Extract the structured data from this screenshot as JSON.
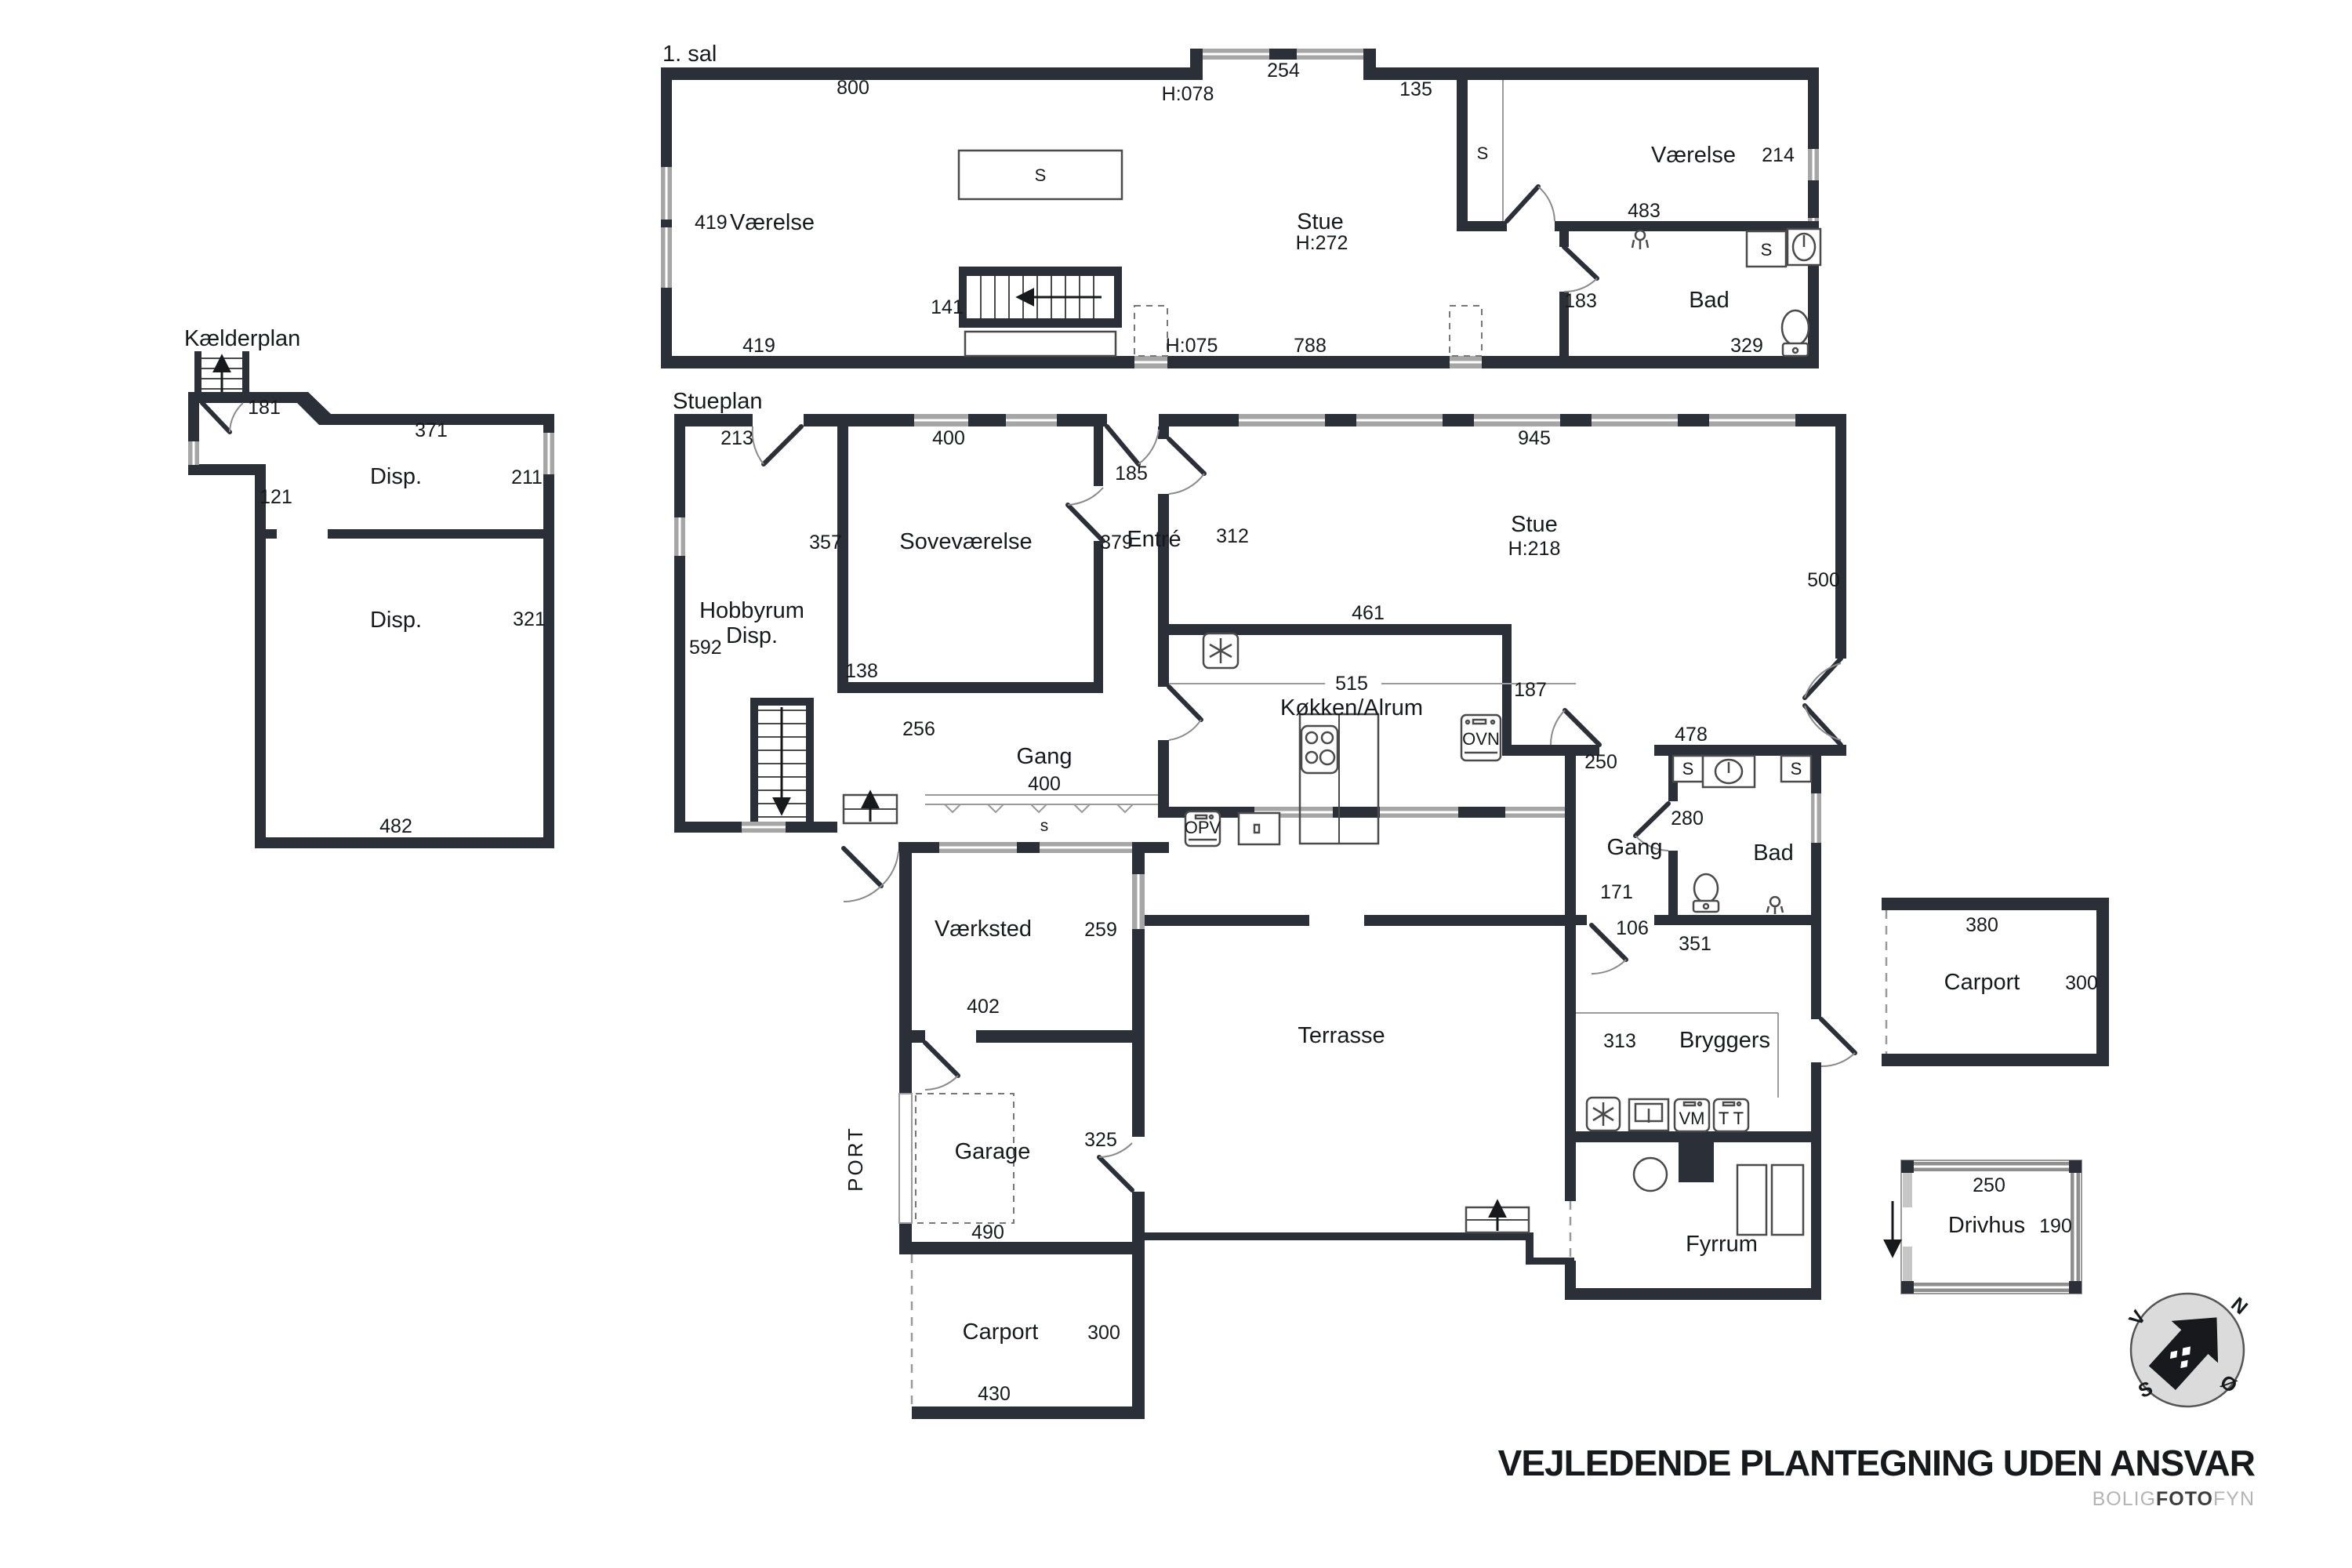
{
  "first_floor": {
    "title": "1. sal",
    "room_left": "Værelse",
    "room_stue": "Stue",
    "stue_h": "H:272",
    "room_right": "Værelse",
    "room_bad": "Bad",
    "closet_mid": "S",
    "closet_right": "S",
    "closet_bad": "S",
    "d_800": "800",
    "d_254": "254",
    "d_h078": "H:078",
    "d_135": "135",
    "d_419_left": "419",
    "d_214": "214",
    "d_483": "483",
    "d_141": "141",
    "d_183": "183",
    "d_329": "329",
    "d_788": "788",
    "d_419_bottom": "419",
    "d_h075": "H:075"
  },
  "basement": {
    "title": "Kælderplan",
    "room1": "Disp.",
    "room2": "Disp.",
    "d_181": "181",
    "d_371": "371",
    "d_121": "121",
    "d_211": "211",
    "d_321": "321",
    "d_482": "482"
  },
  "ground": {
    "title": "Stueplan",
    "rooms": {
      "hobby1": "Hobbyrum",
      "hobby2": "Disp.",
      "sove": "Soveværelse",
      "entre": "Entré",
      "stue": "Stue",
      "stue_h": "H:218",
      "kokken": "Køkken/Alrum",
      "gang": "Gang",
      "gang2": "Gang",
      "bad": "Bad",
      "vaerksted": "Værksted",
      "garage": "Garage",
      "port": "PORT",
      "terrasse": "Terrasse",
      "bryggers": "Bryggers",
      "fyrrum": "Fyrrum",
      "carport": "Carport"
    },
    "appliances": {
      "opv": "OPV",
      "ovn": "OVN",
      "vm": "VM",
      "tt": "T T"
    },
    "closets": {
      "gang_s": "s",
      "bad_s1": "S",
      "bad_s2": "S"
    },
    "dims": {
      "d213": "213",
      "d400a": "400",
      "d185": "185",
      "d945": "945",
      "d357": "357",
      "d379": "379",
      "d312": "312",
      "d592": "592",
      "d138": "138",
      "d461": "461",
      "d515": "515",
      "d187": "187",
      "d500": "500",
      "d256": "256",
      "d400b": "400",
      "d250": "250",
      "d478": "478",
      "d280": "280",
      "d171": "171",
      "d106": "106",
      "d351": "351",
      "d259": "259",
      "d402": "402",
      "d325": "325",
      "d313": "313",
      "d490": "490",
      "d300": "300",
      "d430": "430"
    }
  },
  "outbuildings": {
    "carport": {
      "label": "Carport",
      "d380": "380",
      "d300": "300"
    },
    "drivhus": {
      "label": "Drivhus",
      "d250": "250",
      "d190": "190"
    }
  },
  "compass": {
    "n": "N",
    "v": "V",
    "s": "S",
    "o": "Ø"
  },
  "footer": {
    "disclaimer": "VEJLEDENDE PLANTEGNING UDEN ANSVAR",
    "brand1": "BOLIG",
    "brand2": "FOTO",
    "brand3": "FYN"
  }
}
